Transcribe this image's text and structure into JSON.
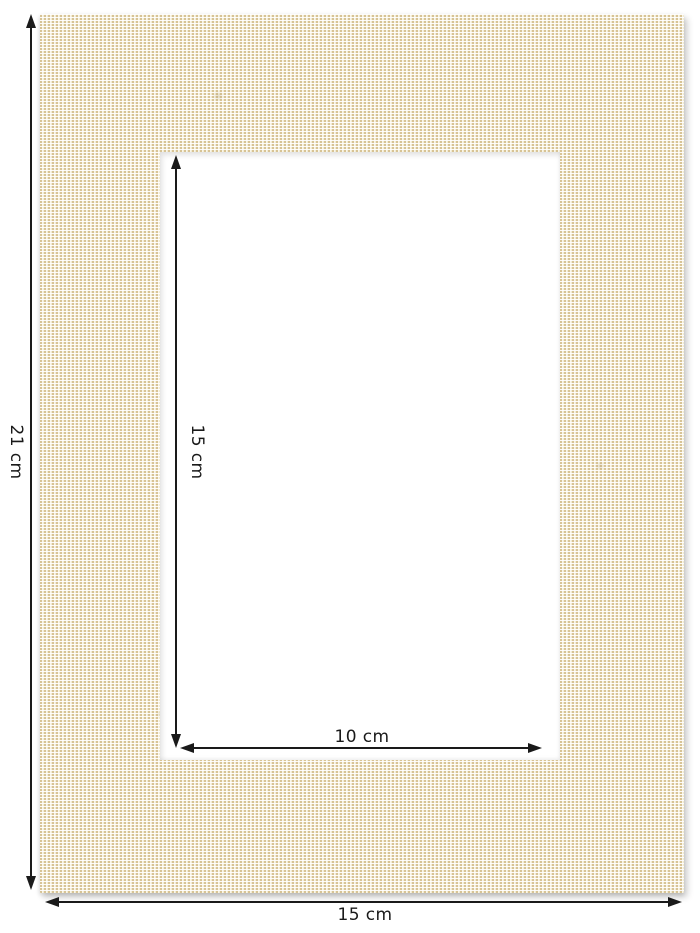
{
  "annotations": {
    "outer_height": {
      "label": "21 cm"
    },
    "outer_width": {
      "label": "15 cm"
    },
    "window_height": {
      "label": "15 cm"
    },
    "window_width": {
      "label": "10 cm"
    }
  },
  "colors": {
    "background": "#ffffff",
    "arrow_ink": "#1a1a1a",
    "fabric_base": "#f2ebd1",
    "fabric_weave_tan": "#d7c395",
    "fabric_weave_highlight": "#ffffff"
  }
}
